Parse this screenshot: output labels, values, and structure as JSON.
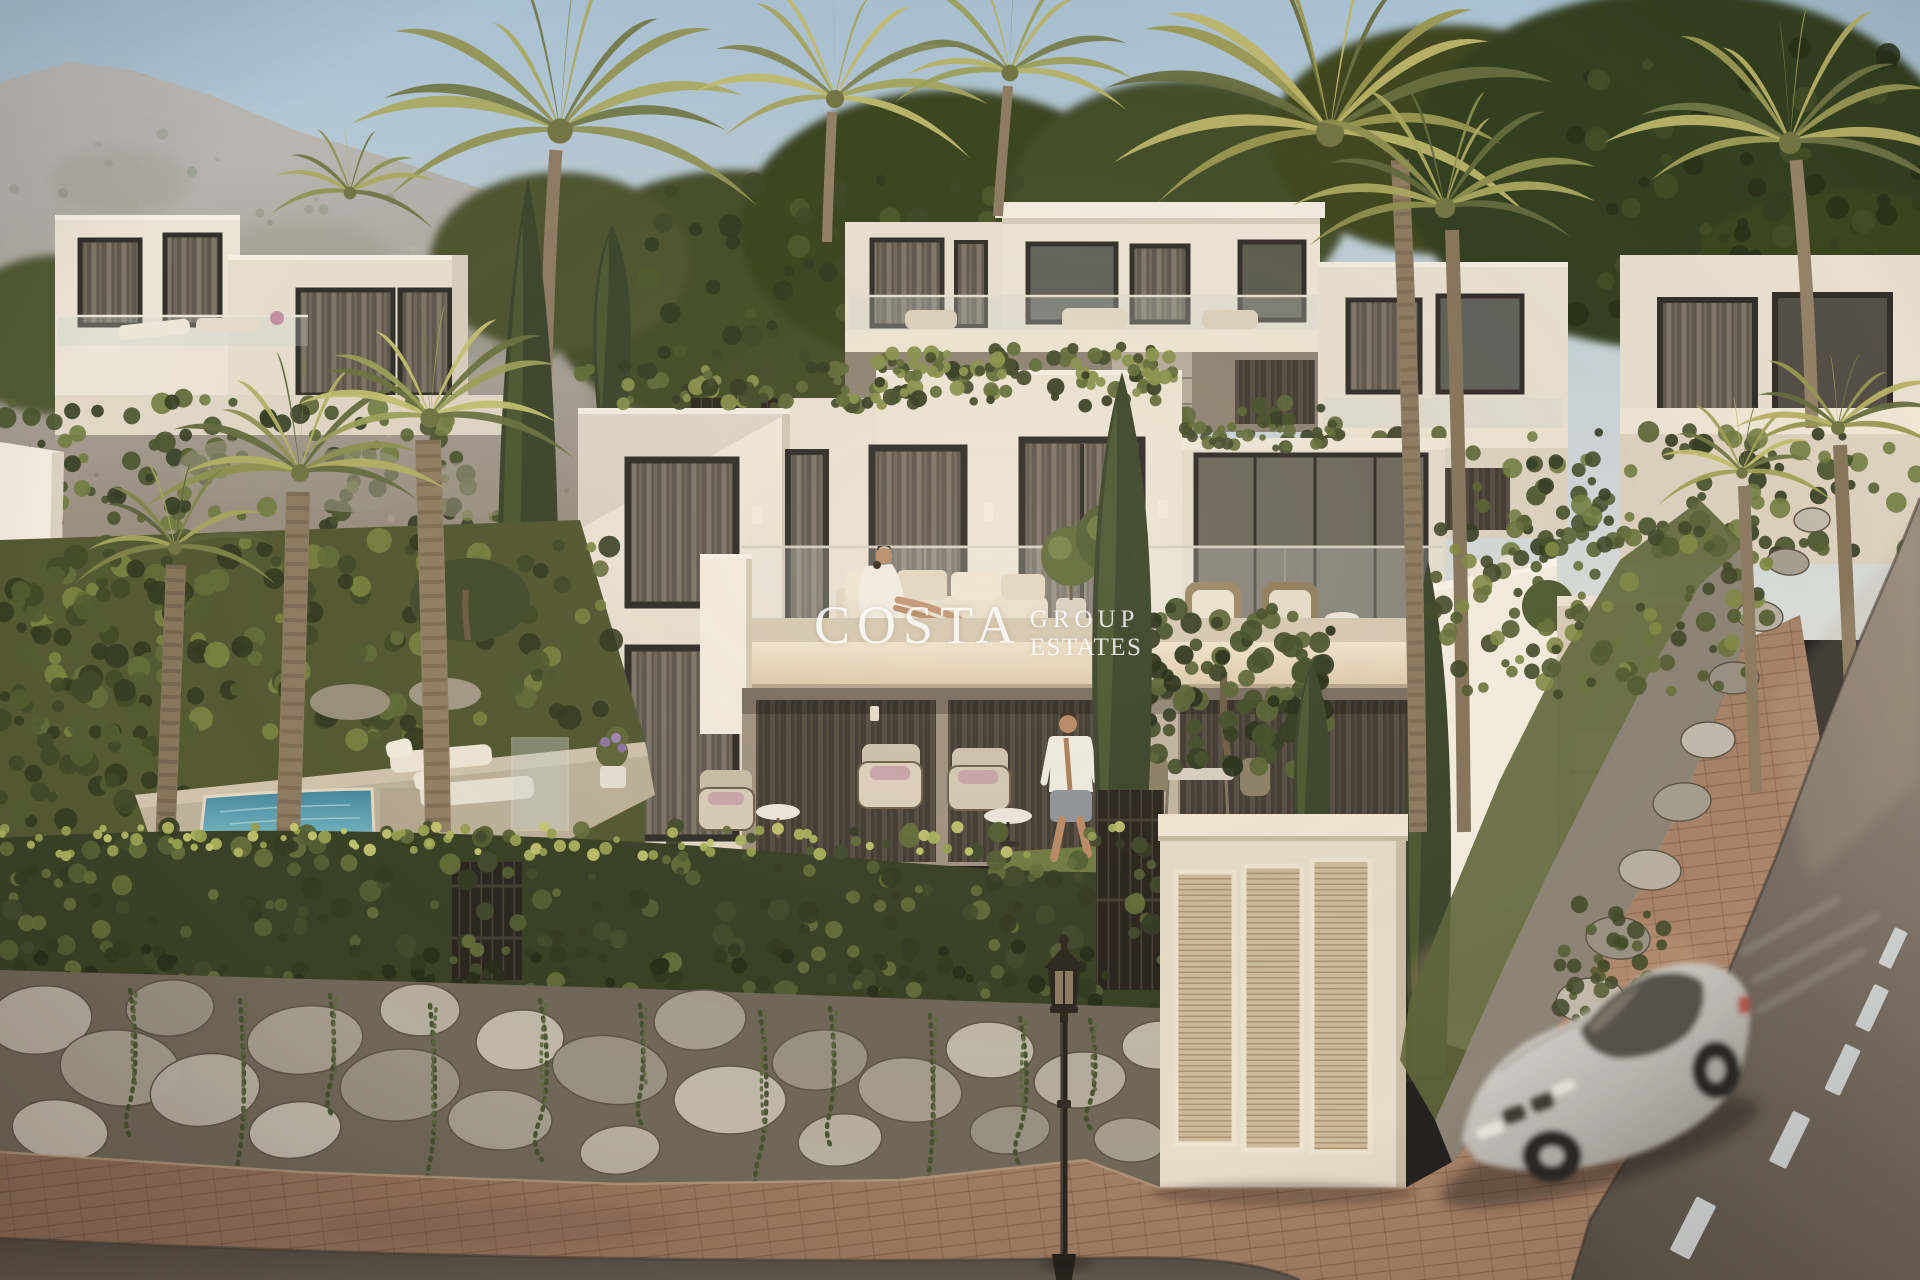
{
  "watermark": {
    "brand": "COSTA",
    "word1": "GROUP",
    "word2": "ESTATES"
  },
  "scene": {
    "description": "Warm sunset 3D architectural render of modern white hillside villas with palm trees, a plunge pool, ivy hedge over a stone retaining wall, louvered gates, a street lamp and a motion-blurred silver sports car on the curving asphalt road",
    "objects": [
      "sky",
      "mountain ridge",
      "background villas",
      "palm trees",
      "cypress trees",
      "main villa",
      "balcony sofa with sunbathing woman",
      "terrace with walking man",
      "plunge pool",
      "sun loungers",
      "ivy hedge",
      "stone retaining wall",
      "dark slat fence",
      "louvered gate panels",
      "garage door",
      "white boundary wall",
      "street lamp",
      "silver sports car",
      "asphalt road",
      "dashed lane markings",
      "brick sidewalk",
      "lawn"
    ]
  },
  "palette": {
    "sky_top": "#a5c2d8",
    "sky_low": "#d9dfde",
    "mountain": "#9a8d7f",
    "villa_white": "#f2ebde",
    "villa_shadow": "#d6ccba",
    "fascia_cream": "#eadbc2",
    "window_dark": "#56514a",
    "foliage_dark": "#2e3a22",
    "foliage_mid": "#55613a",
    "foliage_light": "#a9b063",
    "palm_sun": "#c9c378",
    "hedge_base": "#39432a",
    "stone": "#b2ac9f",
    "road": "#6b6259",
    "lane_marking": "#d5dbde",
    "pavers": "#8f6f5a",
    "pool_water": "#5ba4b5",
    "car_silver": "#c9c8c5",
    "lamp_black": "#26231f",
    "watermark_white": "#ffffff"
  }
}
